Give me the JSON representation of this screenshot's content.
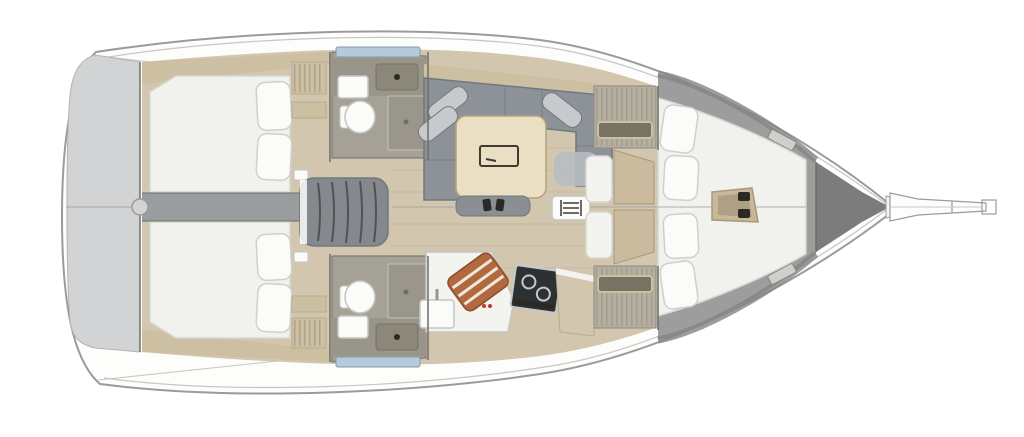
{
  "diagram": {
    "type": "floor-plan",
    "subject": "sailing-yacht-interior-top-view",
    "orientation": "bow-right",
    "rooms": [
      {
        "id": "stern-platform",
        "label": "stern swim platform"
      },
      {
        "id": "aft-cabin-port",
        "label": "aft double cabin port",
        "furniture": [
          "double-berth",
          "pillow",
          "pillow"
        ]
      },
      {
        "id": "aft-cabin-starboard",
        "label": "aft double cabin starboard",
        "furniture": [
          "double-berth",
          "pillow",
          "pillow"
        ]
      },
      {
        "id": "head-port",
        "label": "bathroom port",
        "furniture": [
          "toilet",
          "sink",
          "shower",
          "window"
        ]
      },
      {
        "id": "head-starboard",
        "label": "bathroom starboard",
        "furniture": [
          "toilet",
          "sink",
          "shower",
          "window"
        ]
      },
      {
        "id": "companionway",
        "label": "companionway steps"
      },
      {
        "id": "salon",
        "label": "salon",
        "furniture": [
          "u-sofa",
          "bolster-pillows",
          "dining-table",
          "bench",
          "mast-step"
        ]
      },
      {
        "id": "galley",
        "label": "galley",
        "furniture": [
          "sink",
          "two-burner-stove",
          "bottle-rack",
          "counter"
        ]
      },
      {
        "id": "forward-cabin",
        "label": "forward v-berth cabin",
        "furniture": [
          "v-berth",
          "pillow",
          "pillow",
          "pillow",
          "pillow",
          "step"
        ]
      },
      {
        "id": "bow-locker",
        "label": "anchor locker"
      },
      {
        "id": "bowsprit",
        "label": "bowsprit with anchor roller"
      }
    ]
  },
  "palette": {
    "bg": "#ffffff",
    "hull_fill": "#fdfdfc",
    "hull_stroke": "#9b9b9b",
    "sheer_line": "#c6c6c4",
    "transom": "#d2d3d4",
    "transom_stroke": "#b3b4b5",
    "wood_floor": "#d3c6ae",
    "wood_seam": "#b9ab92",
    "wood_trim": "#cdbfa2",
    "mattress": "#f1f1ee",
    "mattress_stroke": "#d8d7d2",
    "pillow": "#fbfbfa",
    "pillow_stroke": "#cfcfcb",
    "sofa_base": "#8d9298",
    "sofa_edge": "#70787e",
    "sofa_pillow": "#c6cacd",
    "sofa_mat": "#b7bcc0",
    "table_wood": "#eadfc2",
    "table_stroke": "#b3a37b",
    "table_inset": "#3f3b33",
    "bench_dark": "#8a8f93",
    "bath_floor": "#a6a196",
    "bath_counter": "#99958a",
    "basin_dark": "#8b8779",
    "fixture_white": "#fbfbf9",
    "fixture_stroke": "#c5c5c0",
    "window_blue": "#b5cbdc",
    "window_stroke": "#8899a6",
    "stove_dark": "#2e3134",
    "burner": "#c9c9c9",
    "copper": "#b2693f",
    "copper_stripe": "#efe9dc",
    "copper_stroke": "#8a4e2d",
    "gray_deck": "#9d9d9d",
    "gray_deck_dark": "#858585",
    "bow_dark": "#7c7c7c",
    "corridor": "#9a9d9f",
    "steps": "#85898d",
    "step_line": "#4f5357",
    "wall": "#6e6e68",
    "centerline": "#9f9f9f",
    "locker": "#b5afa2",
    "locker_slat": "#8f897b",
    "shelf_dark": "#787265",
    "door_wood": "#cabb9e",
    "door_stroke": "#a8997a",
    "seat_white": "#f3f3f0",
    "knob_dark": "#2c2925",
    "step_tan": "#c9b897",
    "hatch_light": "#cfcfcc",
    "red_mark": "#c23b2a"
  }
}
